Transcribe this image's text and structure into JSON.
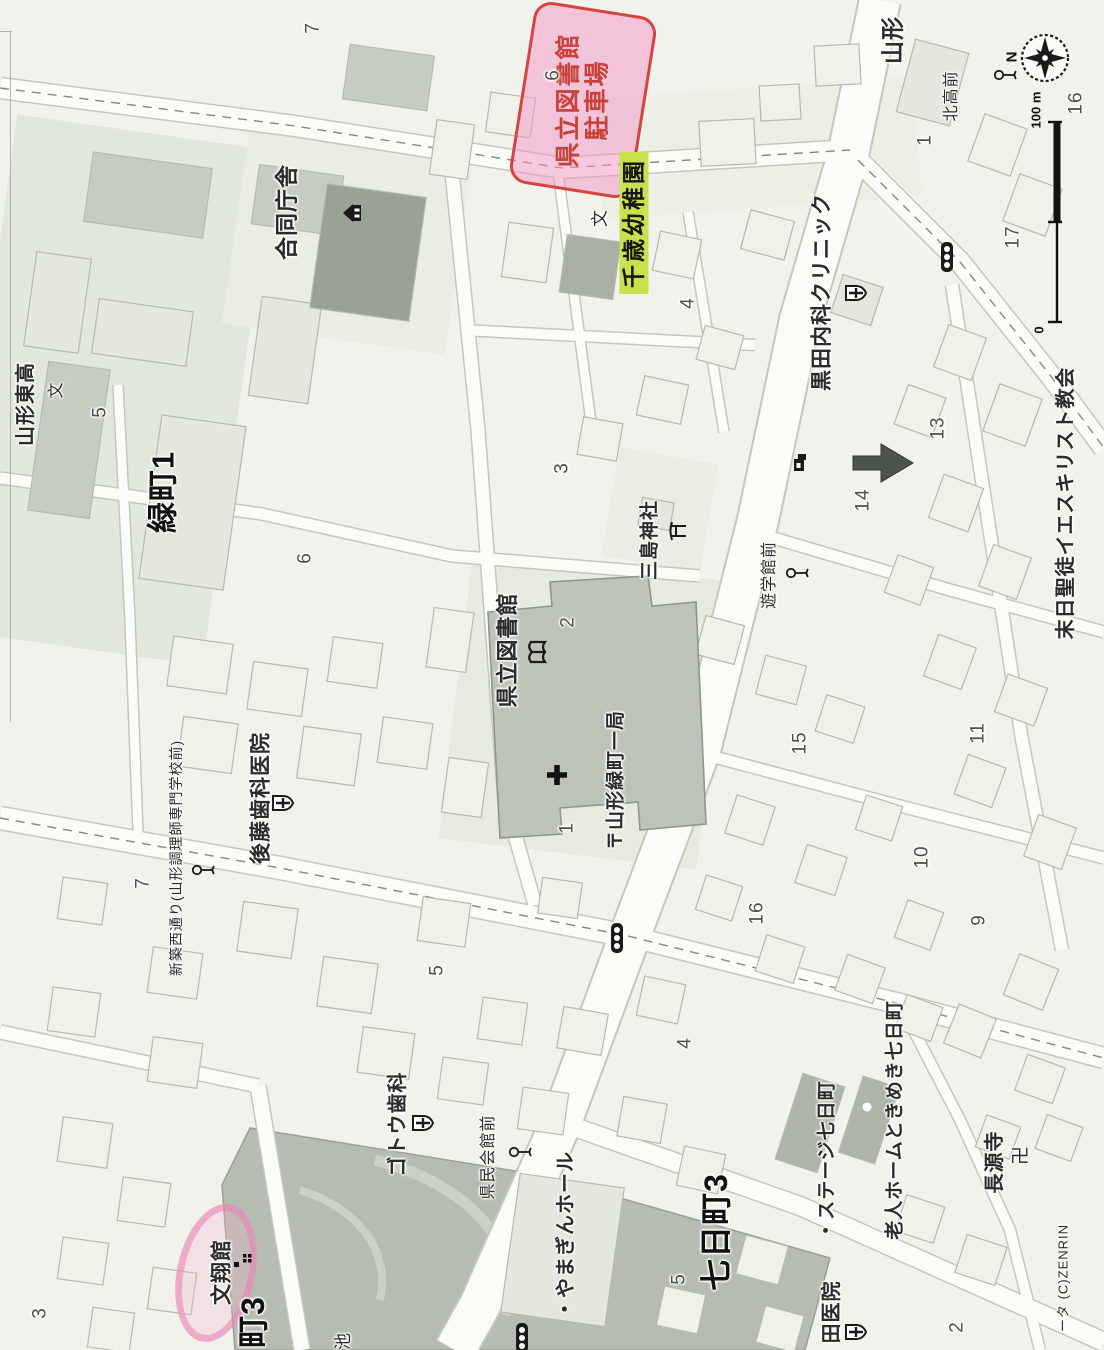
{
  "map": {
    "compass_n": "N",
    "scale": {
      "top": "100 m",
      "bottom": "0"
    },
    "colors": {
      "highlight_pink": "#f299c6",
      "pen_red": "#d5453f",
      "highlight_green": "#c8e14d",
      "park_gray": "#b6bcb1",
      "road_white": "#fbfbf7",
      "public_building_gray": "#9aa295"
    },
    "annotations": {
      "parking": {
        "line1": "県立図書館",
        "line2": "駐車場"
      },
      "kindergarten": "千歳幼稚園"
    },
    "labels": [
      {
        "t": "合同庁舎",
        "x": 287,
        "y": 212,
        "fs": 23,
        "b": 1
      },
      {
        "t": "緑町1",
        "x": 163,
        "y": 492,
        "fs": 31,
        "b": 1,
        "c": "#111"
      },
      {
        "t": "山形東高",
        "x": 26,
        "y": 404,
        "fs": 20,
        "b": 1
      },
      {
        "t": "文",
        "x": 57,
        "y": 390,
        "fs": 16,
        "b": 0
      },
      {
        "t": "山形",
        "x": 893,
        "y": 40,
        "fs": 23,
        "b": 1
      },
      {
        "t": "北高前",
        "x": 952,
        "y": 96,
        "fs": 16,
        "b": 0
      },
      {
        "t": "黒田内科クリニック",
        "x": 822,
        "y": 292,
        "fs": 21,
        "b": 1
      },
      {
        "t": "三島神社",
        "x": 650,
        "y": 540,
        "fs": 19,
        "b": 1
      },
      {
        "t": "県立図書館",
        "x": 508,
        "y": 650,
        "fs": 22,
        "b": 1
      },
      {
        "t": "〒山形緑町一局",
        "x": 616,
        "y": 780,
        "fs": 19,
        "b": 1
      },
      {
        "t": "遊学館前",
        "x": 770,
        "y": 575,
        "fs": 16,
        "b": 0
      },
      {
        "t": "後藤歯科医院",
        "x": 261,
        "y": 798,
        "fs": 21,
        "b": 1
      },
      {
        "t": "新築西通り(山形調理師専門学校前)",
        "x": 176,
        "y": 858,
        "fs": 14,
        "b": 0
      },
      {
        "t": "ゴトウ歯科",
        "x": 398,
        "y": 1124,
        "fs": 20,
        "b": 1
      },
      {
        "t": "県民会館前",
        "x": 489,
        "y": 1157,
        "fs": 16,
        "b": 0
      },
      {
        "t": "・やまぎんホール",
        "x": 566,
        "y": 1235,
        "fs": 20,
        "b": 1
      },
      {
        "t": "七日町3",
        "x": 716,
        "y": 1232,
        "fs": 32,
        "b": 1,
        "c": "#111"
      },
      {
        "t": "・ステージ七日町",
        "x": 827,
        "y": 1160,
        "fs": 19,
        "b": 1
      },
      {
        "t": "老人ホームときめき七日町",
        "x": 895,
        "y": 1120,
        "fs": 19,
        "b": 1
      },
      {
        "t": "長源寺",
        "x": 995,
        "y": 1162,
        "fs": 20,
        "b": 1
      },
      {
        "t": "卍",
        "x": 1021,
        "y": 1155,
        "fs": 19,
        "b": 0
      },
      {
        "t": "田医院",
        "x": 832,
        "y": 1312,
        "fs": 20,
        "b": 1
      },
      {
        "t": "末日聖徒イエスキリスト教会",
        "x": 1066,
        "y": 503,
        "fs": 20,
        "b": 1
      },
      {
        "t": "文",
        "x": 600,
        "y": 218,
        "fs": 17,
        "b": 0
      },
      {
        "t": "池",
        "x": 343,
        "y": 1341,
        "fs": 17,
        "b": 0
      },
      {
        "t": "町3",
        "x": 253,
        "y": 1322,
        "fs": 32,
        "b": 1,
        "c": "#111"
      },
      {
        "t": "文翔館",
        "x": 222,
        "y": 1272,
        "fs": 21,
        "b": 1
      },
      {
        "t": "ータ (C)ZENRIN",
        "x": 1063,
        "y": 1278,
        "fs": 13,
        "b": 0
      }
    ],
    "numbers": [
      {
        "t": "7",
        "x": 313,
        "y": 28
      },
      {
        "t": "6",
        "x": 553,
        "y": 75
      },
      {
        "t": "1",
        "x": 925,
        "y": 140
      },
      {
        "t": "16",
        "x": 1076,
        "y": 103
      },
      {
        "t": "17",
        "x": 1013,
        "y": 237
      },
      {
        "t": "5",
        "x": 100,
        "y": 412
      },
      {
        "t": "6",
        "x": 305,
        "y": 558
      },
      {
        "t": "3",
        "x": 562,
        "y": 468
      },
      {
        "t": "4",
        "x": 688,
        "y": 303
      },
      {
        "t": "2",
        "x": 568,
        "y": 622
      },
      {
        "t": "1",
        "x": 567,
        "y": 828
      },
      {
        "t": "13",
        "x": 938,
        "y": 428
      },
      {
        "t": "14",
        "x": 863,
        "y": 500
      },
      {
        "t": "15",
        "x": 800,
        "y": 743
      },
      {
        "t": "11",
        "x": 978,
        "y": 733
      },
      {
        "t": "16",
        "x": 757,
        "y": 913
      },
      {
        "t": "10",
        "x": 922,
        "y": 857
      },
      {
        "t": "9",
        "x": 979,
        "y": 920
      },
      {
        "t": "7",
        "x": 143,
        "y": 883
      },
      {
        "t": "5",
        "x": 437,
        "y": 970
      },
      {
        "t": "4",
        "x": 685,
        "y": 1043
      },
      {
        "t": "5",
        "x": 679,
        "y": 1279
      },
      {
        "t": "3",
        "x": 40,
        "y": 1313
      },
      {
        "t": "2",
        "x": 957,
        "y": 1327
      }
    ],
    "icons": [
      {
        "n": "government-office-icon",
        "x": 352,
        "y": 213
      },
      {
        "n": "torii-icon",
        "x": 677,
        "y": 531
      },
      {
        "n": "hospital-icon",
        "x": 855,
        "y": 293
      },
      {
        "n": "hospital-icon",
        "x": 282,
        "y": 803
      },
      {
        "n": "hospital-icon",
        "x": 422,
        "y": 1123
      },
      {
        "n": "hospital-icon",
        "x": 855,
        "y": 1332
      },
      {
        "n": "library-icon",
        "x": 538,
        "y": 652
      },
      {
        "n": "cross-icon",
        "x": 557,
        "y": 775
      },
      {
        "n": "arrow-icon",
        "x": 883,
        "y": 463
      },
      {
        "n": "shop-icon",
        "x": 800,
        "y": 462
      },
      {
        "n": "traffic-light-icon",
        "x": 947,
        "y": 257
      },
      {
        "n": "traffic-light-icon",
        "x": 617,
        "y": 938
      },
      {
        "n": "traffic-light-icon",
        "x": 522,
        "y": 1338
      },
      {
        "n": "bus-stop-icon",
        "x": 1005,
        "y": 75
      },
      {
        "n": "bus-stop-icon",
        "x": 797,
        "y": 573
      },
      {
        "n": "bus-stop-icon",
        "x": 203,
        "y": 870
      },
      {
        "n": "bus-stop-icon",
        "x": 520,
        "y": 1152
      },
      {
        "n": "marker-dots-icon",
        "x": 243,
        "y": 1262
      }
    ]
  }
}
